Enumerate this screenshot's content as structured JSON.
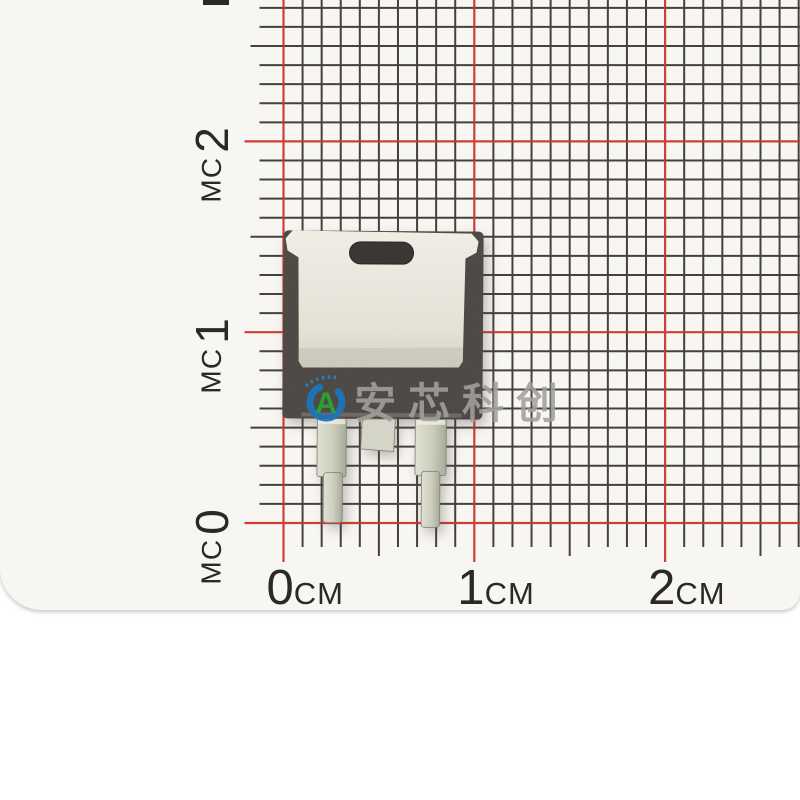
{
  "page": {
    "background": "#ffffff"
  },
  "paper": {
    "color": "#f8f6f2",
    "edge_shadow_color": "#cfccc5"
  },
  "ruler": {
    "unit": "cm",
    "vertical_axis": {
      "labels": [
        {
          "value": "2"
        },
        {
          "value": "1"
        },
        {
          "value": "0"
        }
      ],
      "clipped_top_value": "3"
    },
    "horizontal_axis": {
      "labels": [
        {
          "value": "0"
        },
        {
          "value": "1"
        },
        {
          "value": "2"
        }
      ]
    },
    "grid": {
      "origin_x": 283.5,
      "origin_y": 523,
      "mm_spacing_px": 19.08,
      "mm_per_cm": 10,
      "cols": 28,
      "rows": 28,
      "line_color": "#35322f",
      "cm_line_color": "#c9362c",
      "line_width": 2,
      "cm_line_width": 2.2,
      "tick_minor_len": 24,
      "tick_half_len": 33,
      "tick_cm_len": 39
    }
  },
  "watermark": {
    "text": "安芯科创",
    "logo_letter": "A",
    "logo_ring_color": "#1e74b8",
    "logo_letter_color": "#2f9e33",
    "logo_arc_color": "#2b7fc0",
    "text_color": "rgba(162,160,155,0.88)"
  },
  "component": {
    "body_color": "#45403c",
    "tab_color_top": "#f2f0e7",
    "tab_color_bottom": "#d5d2c4",
    "tab_shade_color": "#cbc8ba",
    "hole_color": "#3a3734",
    "lead_color_light": "#e0e1d3",
    "lead_color_dark": "#a8aa99",
    "lead_edge_color": "#7d8073"
  }
}
